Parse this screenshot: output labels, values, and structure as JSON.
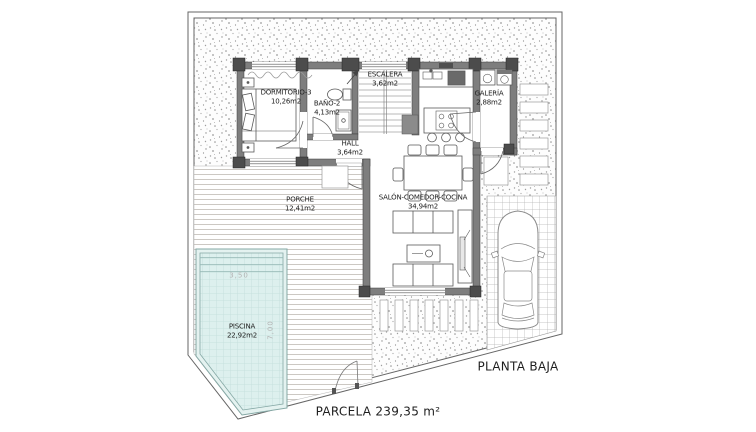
{
  "plan": {
    "title": "PLANTA BAJA",
    "parcel_label": "PARCELA 239,35 m²",
    "rooms": {
      "dormitorio3": {
        "name": "DORMITORIO-3",
        "area": "10,26m2"
      },
      "bano2": {
        "name": "BAÑO-2",
        "area": "4,13m2"
      },
      "escalera": {
        "name": "ESCALERA",
        "area": "3,62m2"
      },
      "galeria": {
        "name": "GALERÍA",
        "area": "2,88m2"
      },
      "hall": {
        "name": "HALL",
        "area": "3,64m2"
      },
      "salon": {
        "name": "SALÓN-COMEDOR-COCINA",
        "area": "34,94m2"
      },
      "porche": {
        "name": "PORCHE",
        "area": "12,41m2"
      },
      "piscina": {
        "name": "PISCINA",
        "area": "22,92m2"
      }
    },
    "pool_dimensions": {
      "width": "3,50",
      "length": "7,00"
    },
    "colors": {
      "pool_water": "#ddf0ee",
      "pool_border": "#85a8a5",
      "wall_fill": "#7e7e7e",
      "pillar_fill": "#4c4c4c",
      "gravel_dot": "#959595",
      "line": "#666666"
    }
  }
}
